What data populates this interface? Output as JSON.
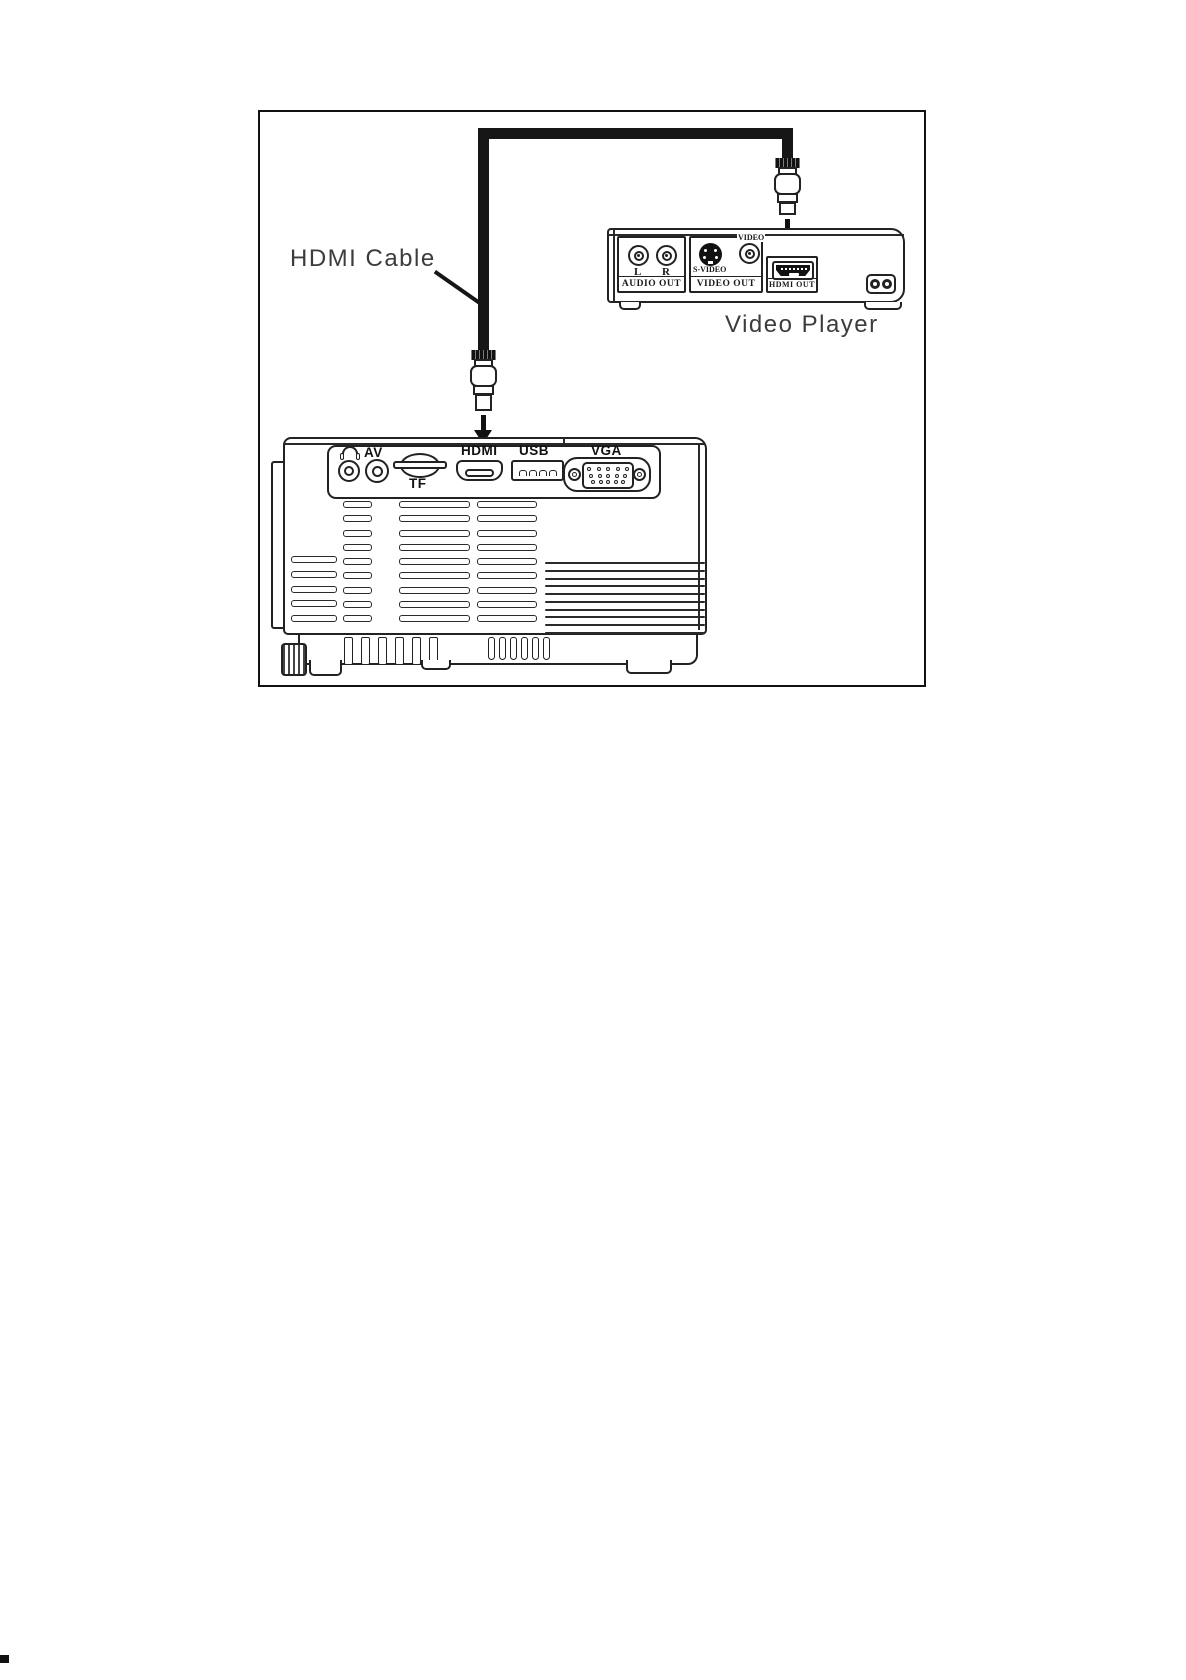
{
  "colors": {
    "line": "#222222",
    "cable": "#161616",
    "label_text": "#3c3c3c",
    "background": "#ffffff"
  },
  "labels": {
    "hdmi_cable": "HDMI Cable",
    "video_player": "Video Player"
  },
  "player": {
    "audio_section": {
      "label": "AUDIO OUT",
      "left_jack": "L",
      "right_jack": "R"
    },
    "video_section": {
      "label": "VIDEO OUT",
      "svideo": "S-VIDEO",
      "video": "VIDEO"
    },
    "hdmi_section": {
      "label": "HDMI OUT"
    }
  },
  "projector": {
    "ports": {
      "av": "AV",
      "tf": "TF",
      "hdmi": "HDMI",
      "usb": "USB",
      "vga": "VGA"
    }
  }
}
